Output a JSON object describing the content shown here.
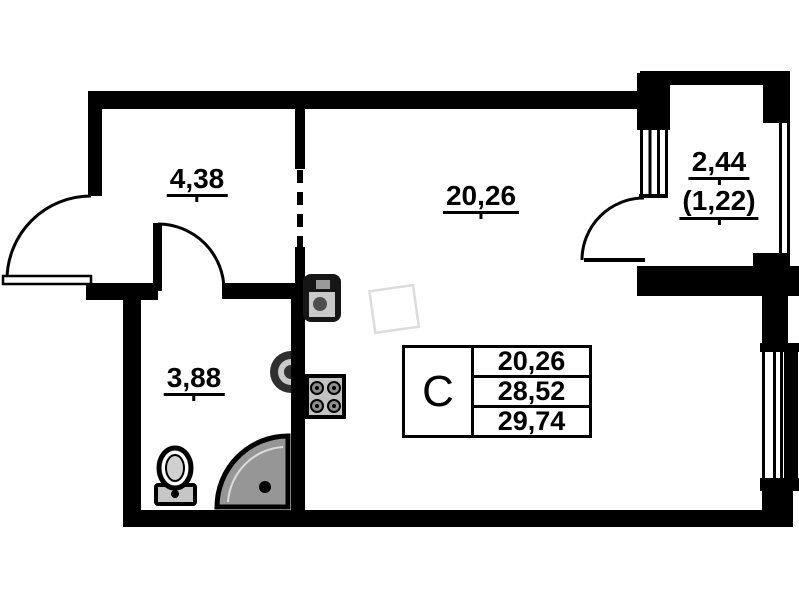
{
  "colors": {
    "wall": "#000000",
    "background": "#ffffff",
    "shower_tray": "#969696",
    "fixture_gray": "#c2c2c2",
    "ghost_outline": "#dcdcdc"
  },
  "rooms": {
    "hallway": {
      "area": "4,38"
    },
    "living_room": {
      "area": "20,26"
    },
    "bathroom": {
      "area": "3,88"
    },
    "balcony": {
      "area": "2,44",
      "area_coefficient": "(1,22)"
    }
  },
  "legend_table": {
    "unit_type": "С",
    "values": [
      "20,26",
      "28,52",
      "29,74"
    ]
  },
  "fixtures": [
    "entrance-door",
    "bathroom-door",
    "balcony-door",
    "balcony-window",
    "facade-window",
    "balcony-glazing",
    "kitchen-sink",
    "stove",
    "washbasin",
    "toilet",
    "shower-tray",
    "refrigerator-ghost"
  ]
}
